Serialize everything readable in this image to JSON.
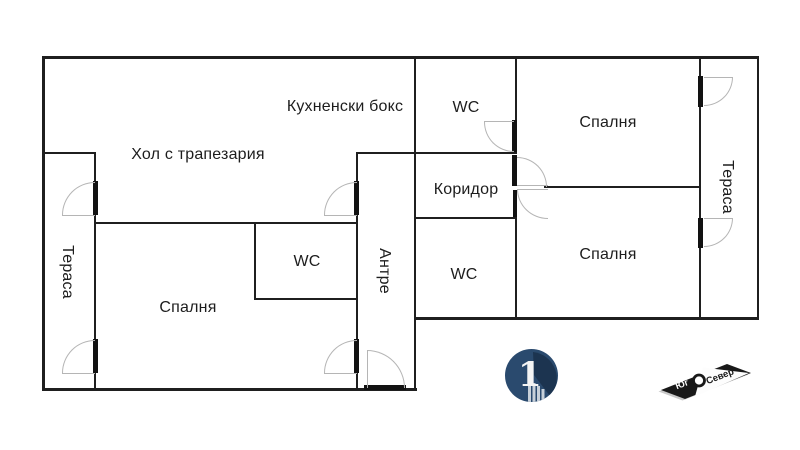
{
  "window": {
    "background": "#ffffff"
  },
  "floorplan": {
    "rooms": {
      "kitchen": "Кухненски бокс",
      "living_room": "Хол с трапезария",
      "terrace_left": "Тераса",
      "bedroom_left": "Спалня",
      "wc_left": "WC",
      "entry_hall": "Антре",
      "wc_top": "WC",
      "corridor": "Коридор",
      "wc_middle": "WC",
      "bedroom_top_right": "Спалня",
      "bedroom_bottom_right": "Спалня",
      "terrace_right": "Тераса"
    },
    "colors": {
      "wall": "#1f1f1f",
      "door_arc": "#b5b5b5",
      "background": "#ffffff"
    }
  },
  "branding": {
    "logo_one": {
      "glyph": "1",
      "circle_color": "#2a4a6e",
      "shadow_color": "#1c3450",
      "building_color": "#c7d0d9"
    },
    "compass": {
      "south_label": "Юг",
      "north_label": "Север",
      "body_color": "#191919"
    }
  }
}
